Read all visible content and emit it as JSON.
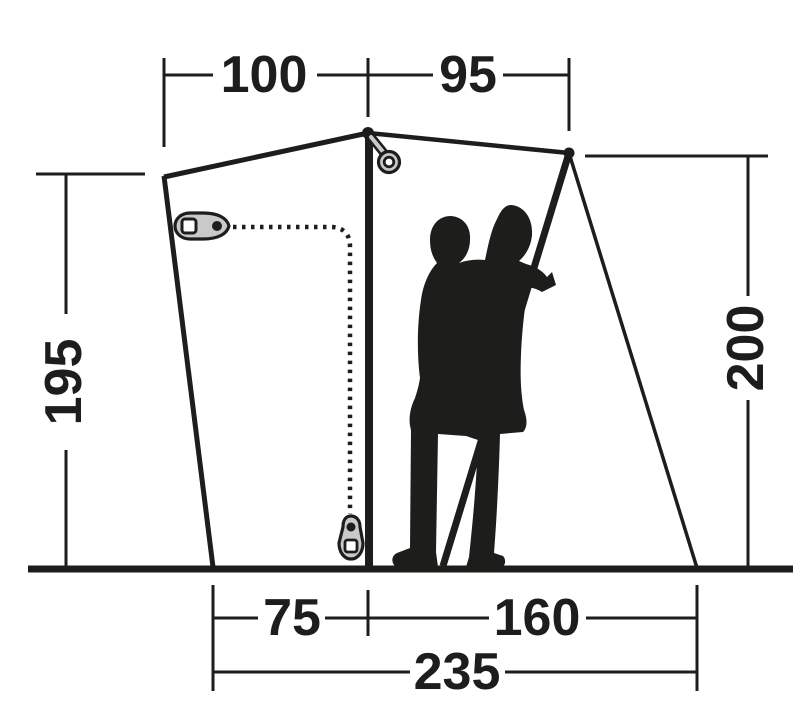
{
  "diagram": {
    "name": "Tent dimension diagram",
    "dims": {
      "top_left": "100",
      "top_right": "95",
      "left_height": "195",
      "right_height": "200",
      "bottom_left": "75",
      "bottom_right": "160",
      "bottom_total": "235"
    },
    "colors": {
      "line": "#1d1d1b",
      "background": "#ffffff",
      "hardware_fill": "#c9c9c9",
      "hardware_hole": "#ffffff"
    },
    "icons": [
      "zipper-pull-icon",
      "zipper-pull-icon",
      "hang-loop-icon",
      "person-carrying-child-silhouette"
    ]
  }
}
